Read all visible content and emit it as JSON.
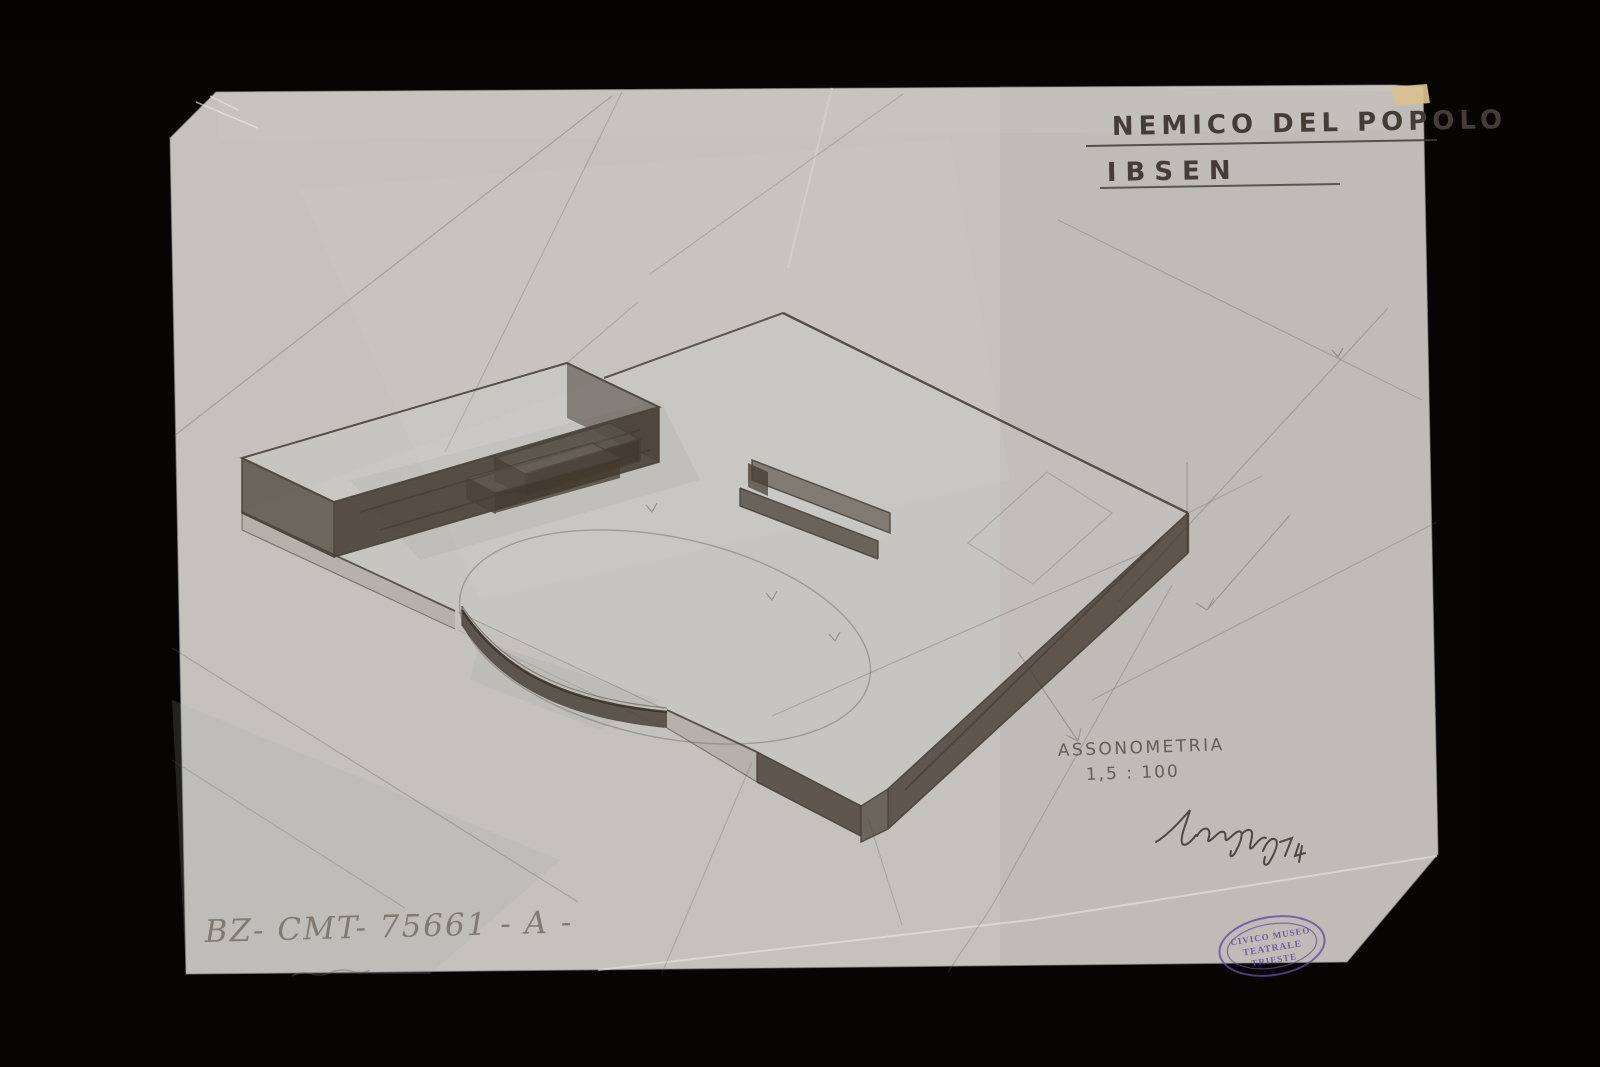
{
  "artwork": {
    "title_line1": "NEMICO DEL POPOLO",
    "title_line2": "IBSEN",
    "annotation_type": "ASSONOMETRIA",
    "annotation_scale": "1,5 : 100",
    "inventory_number": "BZ- CMT- 75661 - A -",
    "stamp": {
      "line1": "CIVICO MUSEO",
      "line2": "TEATRALE",
      "line3": "TRIESTE"
    }
  },
  "colors": {
    "background": "#050403",
    "paper": "#c5c2bd",
    "pencil": "#4a423a",
    "stamp_ink": "#5e4d9c",
    "tape": "#d9c18f"
  }
}
